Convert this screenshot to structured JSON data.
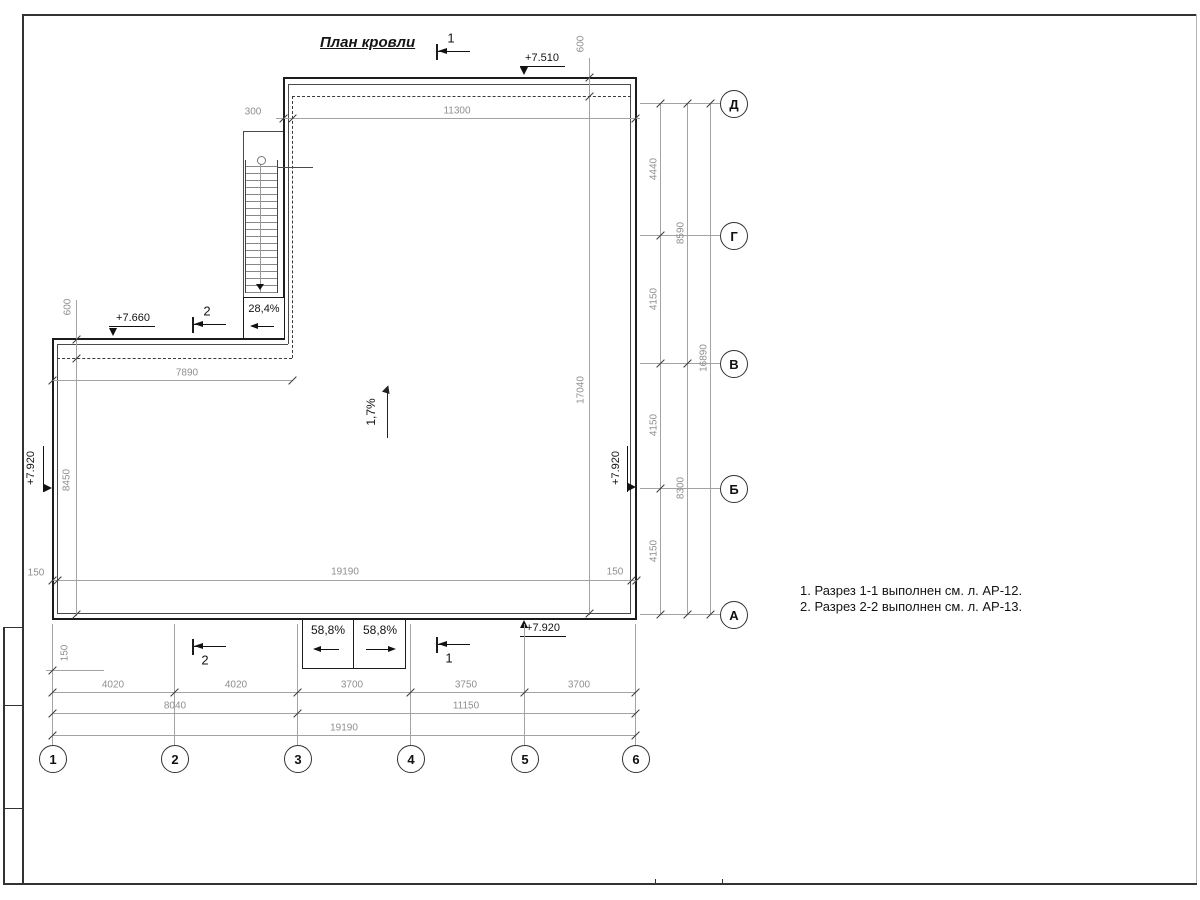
{
  "title": "План кровли",
  "notes": {
    "line1": "1. Разрез 1-1 выполнен см. л. АР-12.",
    "line2": "2. Разрез 2-2 выполнен см. л. АР-13."
  },
  "axes": {
    "letters": [
      "Д",
      "Г",
      "В",
      "Б",
      "А"
    ],
    "numbers": [
      "1",
      "2",
      "3",
      "4",
      "5",
      "6"
    ]
  },
  "elevations": {
    "top": "+7.510",
    "wing": "+7.660",
    "left": "+7.920",
    "right": "+7.920",
    "bottom": "+7.920"
  },
  "slopes": {
    "roof": "1,7%",
    "ladder": "28,4%",
    "ramp_left": "58,8%",
    "ramp_right": "58,8%"
  },
  "sections": {
    "cut1": "1",
    "cut2": "2"
  },
  "dims": {
    "top_300": "300",
    "top_11300": "11300",
    "top_600": "600",
    "left_600": "600",
    "left_7890": "7890",
    "left_8450": "8450",
    "left_150_row": "150",
    "left_150_col": "150",
    "right_150_row": "150",
    "inner_17040": "17040",
    "inner_19190": "19190",
    "right_tier1": [
      "4440",
      "4150",
      "4150",
      "4150"
    ],
    "right_tier2": [
      "8590",
      "8300"
    ],
    "right_tier3": "16890",
    "bottom_tier1": [
      "4020",
      "4020",
      "3700",
      "3750",
      "3700"
    ],
    "bottom_tier2": [
      "8040",
      "11150"
    ],
    "bottom_tier3": "19190"
  }
}
